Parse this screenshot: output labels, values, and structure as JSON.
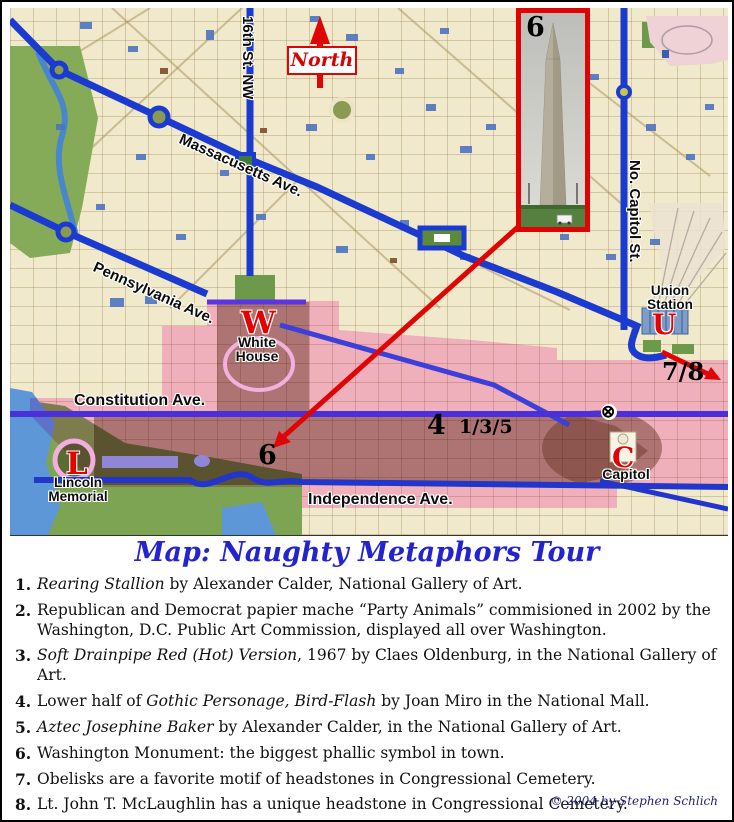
{
  "colors": {
    "route_blue": "#1b3ad0",
    "constitution_purple": "#4b2fd8",
    "accent_red": "#e00505",
    "overlay_pink": "#fc6cd2",
    "title_blue": "#2323cf",
    "map_base": "#f0e9cb"
  },
  "map": {
    "north_label": "North",
    "streets": {
      "sixteenth": "16th St. NW",
      "massachusetts": "Massacusetts Ave.",
      "no_capitol": "No. Capitol St.",
      "pennsylvania": "Pennsylvania Ave.",
      "constitution": "Constitution Ave.",
      "independence": "Independence Ave."
    },
    "landmarks": {
      "white_house": {
        "letter": "W",
        "name": "White House"
      },
      "union_station": {
        "letter": "U",
        "name": "Union Station"
      },
      "lincoln": {
        "letter": "L",
        "name": "Lincoln Memorial"
      },
      "capitol": {
        "letter": "C",
        "name": "Capitol"
      }
    },
    "markers": {
      "inset_number": "6",
      "mall_monument_number": "6",
      "mall_number_4": "4",
      "gallery_numbers": "1/3/5",
      "cemetery_numbers": "7/8",
      "crossed_circle": "⊗"
    }
  },
  "title": "Map: Naughty Metaphors Tour",
  "legend": {
    "items": [
      {
        "number": "1.",
        "segments": [
          {
            "text": "Rearing Stallion",
            "italic": true
          },
          {
            "text": " by Alexander Calder, National Gallery of Art.",
            "italic": false
          }
        ]
      },
      {
        "number": "2.",
        "segments": [
          {
            "text": "Republican and Democrat papier mache “Party Animals” commisioned in 2002 by the Washington, D.C. Public Art Commission, displayed all over Washington.",
            "italic": false
          }
        ]
      },
      {
        "number": "3.",
        "segments": [
          {
            "text": "Soft Drainpipe Red (Hot) Version",
            "italic": true
          },
          {
            "text": ", 1967 by Claes Oldenburg, in the National Gallery of Art.",
            "italic": false
          }
        ]
      },
      {
        "number": "4.",
        "segments": [
          {
            "text": "Lower half of ",
            "italic": false
          },
          {
            "text": "Gothic Personage, Bird-Flash",
            "italic": true
          },
          {
            "text": " by Joan Miro in the National Mall.",
            "italic": false
          }
        ]
      },
      {
        "number": "5.",
        "segments": [
          {
            "text": "Aztec Josephine Baker",
            "italic": true
          },
          {
            "text": " by Alexander Calder, in the National Gallery of Art.",
            "italic": false
          }
        ]
      },
      {
        "number": "6.",
        "segments": [
          {
            "text": "Washington Monument: the biggest phallic symbol in town.",
            "italic": false
          }
        ]
      },
      {
        "number": "7.",
        "segments": [
          {
            "text": "Obelisks are a favorite motif of headstones in Congressional Cemetery.",
            "italic": false
          }
        ]
      },
      {
        "number": "8.",
        "segments": [
          {
            "text": "Lt. John T. McLaughlin has a unique headstone in Congressional Cemetery.",
            "italic": false
          }
        ]
      }
    ]
  },
  "footer": {
    "copyright": "© 2004 by Stephen Schlich"
  }
}
